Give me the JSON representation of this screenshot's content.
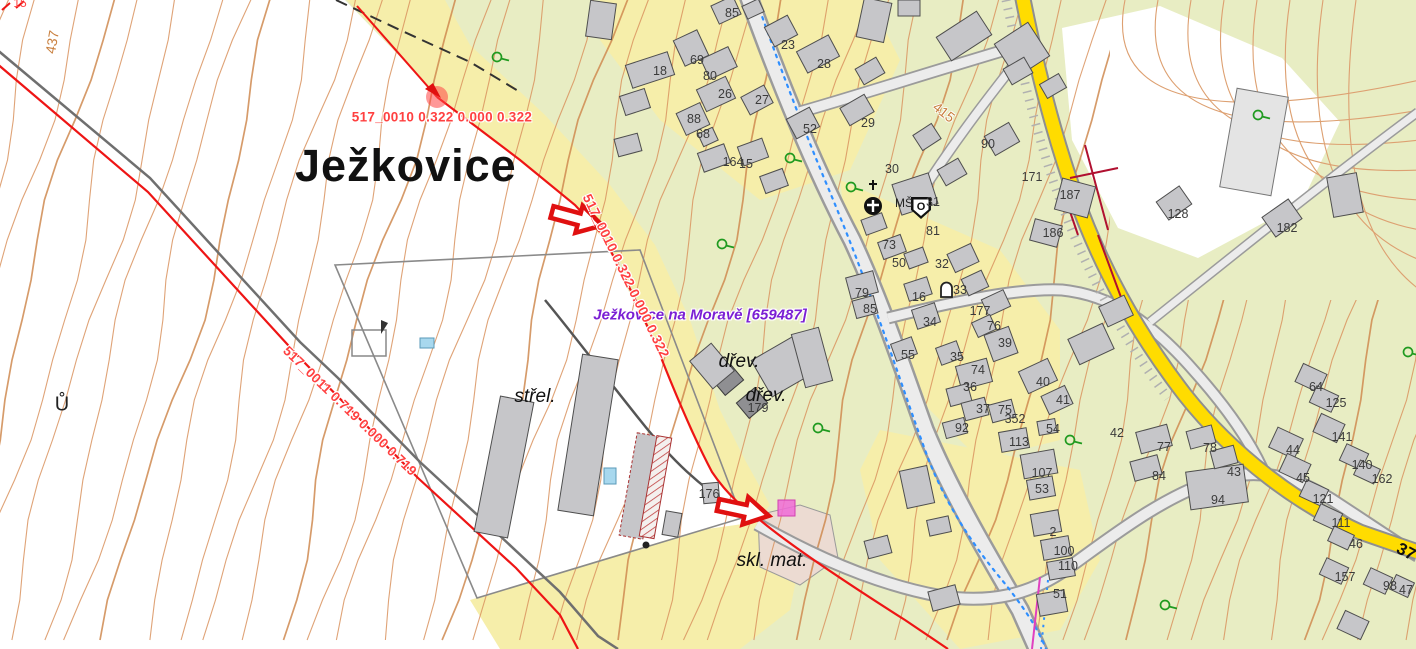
{
  "map_title": "Ježkovice cadastral map",
  "place_label": {
    "text": "Ježkovice"
  },
  "municipality_label": {
    "text": "Ježkovice na Moravě [659487]",
    "color": "#7b1fd4"
  },
  "parcel_measurements": [
    {
      "text": "517_0010 0.322 0.000 0.322",
      "x": 442,
      "y": 117,
      "rot": 0
    },
    {
      "text": "517_0010 0.322 0.000 0.322",
      "x": 626,
      "y": 276,
      "rot": 64
    },
    {
      "text": "517_0011 0.719 0.000 0.719",
      "x": 350,
      "y": 411,
      "rot": 44
    }
  ],
  "feature_labels": [
    {
      "text": "střel.",
      "x": 535,
      "y": 397
    },
    {
      "text": "dřev.",
      "x": 739,
      "y": 362
    },
    {
      "text": "dřev.",
      "x": 766,
      "y": 396
    },
    {
      "text": "skl. mat.",
      "x": 772,
      "y": 561
    }
  ],
  "contour_labels": [
    {
      "text": "437",
      "x": 52,
      "y": 42,
      "rot": -80
    },
    {
      "text": "415",
      "x": 944,
      "y": 112,
      "rot": 38
    }
  ],
  "misc_labels": [
    {
      "text": "Ů",
      "x": 62,
      "y": 405,
      "cls": "edge"
    },
    {
      "text": "MŠ",
      "x": 904,
      "y": 203,
      "cls": "ms"
    },
    {
      "text": "37",
      "x": 1406,
      "y": 552,
      "rot": 28,
      "cls": "roadnum"
    },
    {
      "text": "15",
      "x": 20,
      "y": 3,
      "cls": "rededge"
    }
  ],
  "church_shield_letter": "O",
  "house_numbers": [
    {
      "n": "85",
      "x": 732,
      "y": 13
    },
    {
      "n": "23",
      "x": 788,
      "y": 45
    },
    {
      "n": "28",
      "x": 824,
      "y": 64
    },
    {
      "n": "69",
      "x": 697,
      "y": 60
    },
    {
      "n": "80",
      "x": 710,
      "y": 76
    },
    {
      "n": "26",
      "x": 725,
      "y": 94
    },
    {
      "n": "27",
      "x": 762,
      "y": 100
    },
    {
      "n": "88",
      "x": 694,
      "y": 119
    },
    {
      "n": "68",
      "x": 703,
      "y": 134
    },
    {
      "n": "52",
      "x": 810,
      "y": 129
    },
    {
      "n": "18",
      "x": 660,
      "y": 71
    },
    {
      "n": "164",
      "x": 733,
      "y": 162
    },
    {
      "n": "15",
      "x": 746,
      "y": 164
    },
    {
      "n": "29",
      "x": 868,
      "y": 123
    },
    {
      "n": "30",
      "x": 892,
      "y": 169
    },
    {
      "n": "90",
      "x": 988,
      "y": 144
    },
    {
      "n": "171",
      "x": 1032,
      "y": 177
    },
    {
      "n": "187",
      "x": 1070,
      "y": 195
    },
    {
      "n": "186",
      "x": 1053,
      "y": 233
    },
    {
      "n": "128",
      "x": 1178,
      "y": 214
    },
    {
      "n": "182",
      "x": 1287,
      "y": 228
    },
    {
      "n": "31",
      "x": 933,
      "y": 202
    },
    {
      "n": "81",
      "x": 933,
      "y": 231
    },
    {
      "n": "73",
      "x": 889,
      "y": 245
    },
    {
      "n": "50",
      "x": 899,
      "y": 263
    },
    {
      "n": "79",
      "x": 862,
      "y": 293
    },
    {
      "n": "85",
      "x": 870,
      "y": 309
    },
    {
      "n": "16",
      "x": 919,
      "y": 297
    },
    {
      "n": "34",
      "x": 930,
      "y": 322
    },
    {
      "n": "32",
      "x": 942,
      "y": 264
    },
    {
      "n": "33",
      "x": 960,
      "y": 290
    },
    {
      "n": "177",
      "x": 980,
      "y": 311
    },
    {
      "n": "76",
      "x": 994,
      "y": 326
    },
    {
      "n": "35",
      "x": 957,
      "y": 357
    },
    {
      "n": "55",
      "x": 908,
      "y": 355
    },
    {
      "n": "39",
      "x": 1005,
      "y": 343
    },
    {
      "n": "74",
      "x": 978,
      "y": 370
    },
    {
      "n": "36",
      "x": 970,
      "y": 387
    },
    {
      "n": "40",
      "x": 1043,
      "y": 382
    },
    {
      "n": "41",
      "x": 1063,
      "y": 400
    },
    {
      "n": "37",
      "x": 983,
      "y": 409
    },
    {
      "n": "75",
      "x": 1005,
      "y": 410
    },
    {
      "n": "92",
      "x": 962,
      "y": 428
    },
    {
      "n": "113",
      "x": 1019,
      "y": 442
    },
    {
      "n": "54",
      "x": 1053,
      "y": 429
    },
    {
      "n": "352",
      "x": 1015,
      "y": 419
    },
    {
      "n": "107",
      "x": 1042,
      "y": 473
    },
    {
      "n": "53",
      "x": 1042,
      "y": 489
    },
    {
      "n": "2",
      "x": 1053,
      "y": 532
    },
    {
      "n": "100",
      "x": 1064,
      "y": 551
    },
    {
      "n": "110",
      "x": 1068,
      "y": 566
    },
    {
      "n": "51",
      "x": 1060,
      "y": 594
    },
    {
      "n": "77",
      "x": 1164,
      "y": 447
    },
    {
      "n": "84",
      "x": 1159,
      "y": 476
    },
    {
      "n": "94",
      "x": 1218,
      "y": 500
    },
    {
      "n": "43",
      "x": 1234,
      "y": 472
    },
    {
      "n": "78",
      "x": 1210,
      "y": 448
    },
    {
      "n": "42",
      "x": 1117,
      "y": 433
    },
    {
      "n": "64",
      "x": 1316,
      "y": 387
    },
    {
      "n": "125",
      "x": 1336,
      "y": 403
    },
    {
      "n": "141",
      "x": 1342,
      "y": 437
    },
    {
      "n": "44",
      "x": 1293,
      "y": 450
    },
    {
      "n": "45",
      "x": 1303,
      "y": 478
    },
    {
      "n": "140",
      "x": 1362,
      "y": 465
    },
    {
      "n": "162",
      "x": 1382,
      "y": 479
    },
    {
      "n": "121",
      "x": 1323,
      "y": 499
    },
    {
      "n": "111",
      "x": 1341,
      "y": 523
    },
    {
      "n": "46",
      "x": 1356,
      "y": 544
    },
    {
      "n": "157",
      "x": 1345,
      "y": 577
    },
    {
      "n": "98",
      "x": 1390,
      "y": 586
    },
    {
      "n": "47",
      "x": 1406,
      "y": 590
    },
    {
      "n": "176",
      "x": 709,
      "y": 494
    },
    {
      "n": "179",
      "x": 758,
      "y": 408
    }
  ],
  "tree_symbols": [
    [
      497,
      57
    ],
    [
      790,
      158
    ],
    [
      851,
      187
    ],
    [
      722,
      244
    ],
    [
      818,
      428
    ],
    [
      1070,
      440
    ],
    [
      1258,
      115
    ],
    [
      1165,
      605
    ],
    [
      1408,
      352
    ]
  ],
  "colors": {
    "vegetation": "#e8edc3",
    "parcel_yellow": "#f6eeaa",
    "building_gray": "#c6c6c9",
    "road_yellow": "#ffdc00",
    "contour_orange": "#d9935f",
    "boundary_red": "#ee1515",
    "annotation_red": "#e01010",
    "municipality_purple": "#7b1fd4",
    "storage_pink": "#ecdbd2",
    "highlight_magenta": "#f06ad8",
    "water_blue": "#2f8fff"
  }
}
